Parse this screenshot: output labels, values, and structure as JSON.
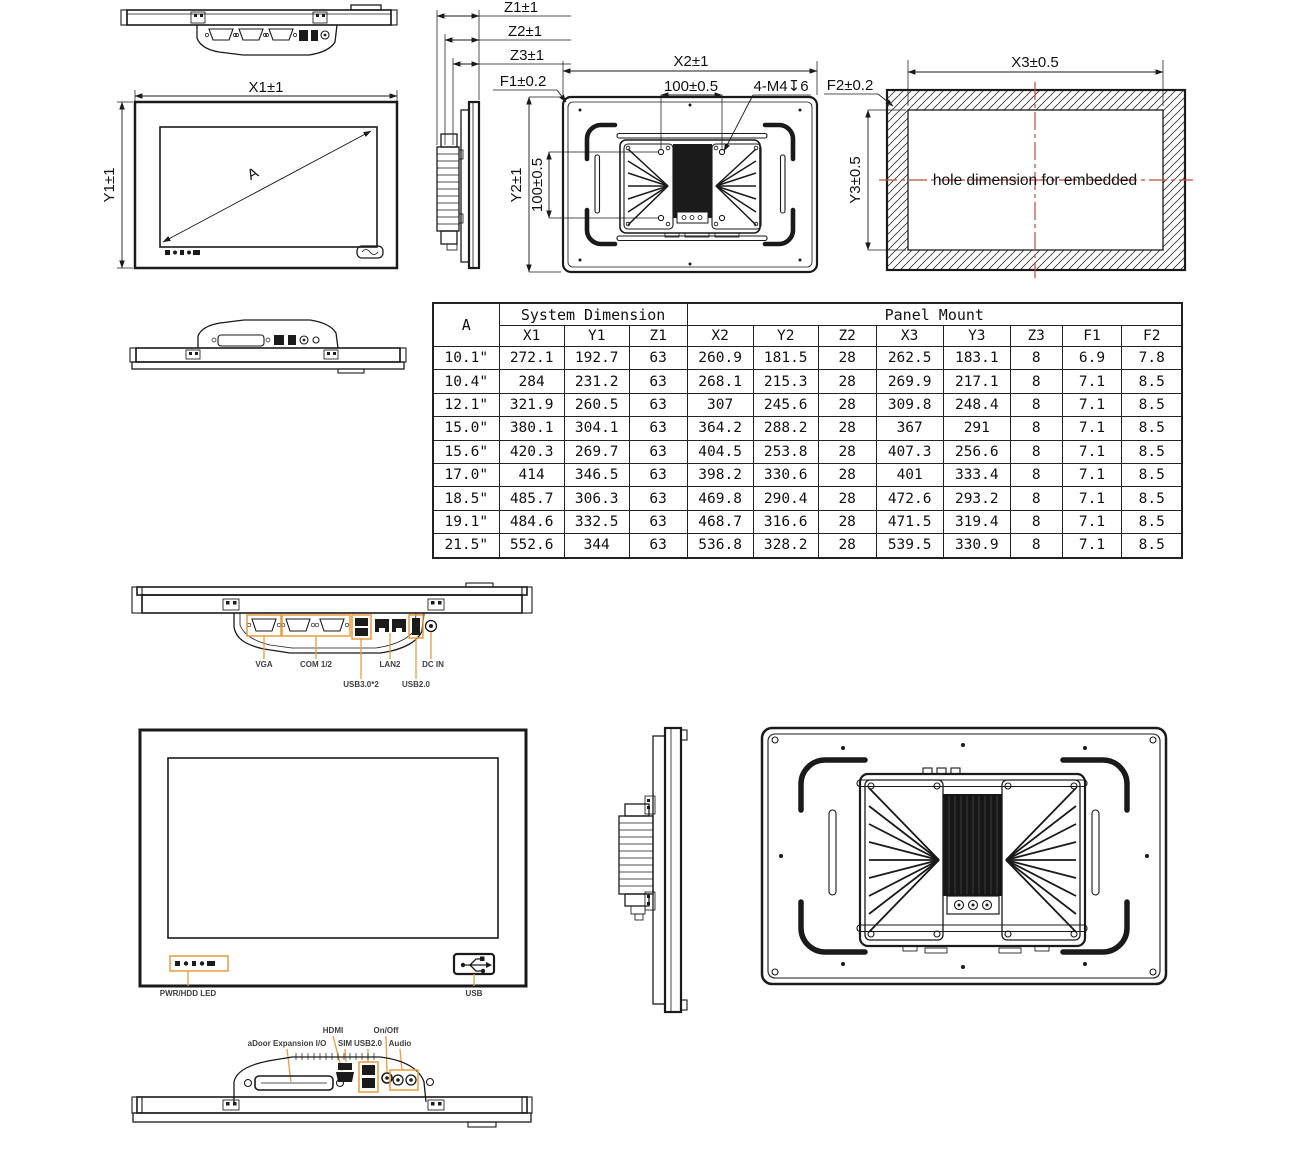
{
  "colors": {
    "line_black": "#1a1a1a",
    "highlight_orange": "#e89c3e",
    "centerline_red": "#bf4a3c"
  },
  "annotations": {
    "front": {
      "width": "X1±1",
      "height": "Y1±1",
      "diagonal_label": "A"
    },
    "side": {
      "z1": "Z1±1",
      "z2": "Z2±1",
      "z3": "Z3±1",
      "f1": "F1±0.2"
    },
    "rear": {
      "width": "X2±1",
      "vesa_h": "100±0.5",
      "thread": "4-M4↧6",
      "height": "Y2±1",
      "vesa_v": "100±0.5"
    },
    "cutout": {
      "width": "X3±0.5",
      "height": "Y3±0.5",
      "f2": "F2±0.2",
      "note": "hole dimension for embedded"
    }
  },
  "io_bottom": {
    "labels": [
      "VGA",
      "COM 1/2",
      "USB3.0*2",
      "LAN2",
      "USB2.0",
      "DC IN"
    ]
  },
  "front_panel": {
    "led": "PWR/HDD LED",
    "usb": "USB"
  },
  "io_top": {
    "labels": [
      "aDoor Expansion I/O",
      "HDMI",
      "SIM",
      "USB2.0",
      "On/Off",
      "Audio"
    ]
  },
  "dimension_table": {
    "corner_header": "A",
    "group_headers": [
      "System Dimension",
      "Panel Mount"
    ],
    "columns": [
      "X1",
      "Y1",
      "Z1",
      "X2",
      "Y2",
      "Z2",
      "X3",
      "Y3",
      "Z3",
      "F1",
      "F2"
    ],
    "rows": [
      {
        "size": "10.1\"",
        "values": [
          "272.1",
          "192.7",
          "63",
          "260.9",
          "181.5",
          "28",
          "262.5",
          "183.1",
          "8",
          "6.9",
          "7.8"
        ]
      },
      {
        "size": "10.4\"",
        "values": [
          "284",
          "231.2",
          "63",
          "268.1",
          "215.3",
          "28",
          "269.9",
          "217.1",
          "8",
          "7.1",
          "8.5"
        ]
      },
      {
        "size": "12.1\"",
        "values": [
          "321.9",
          "260.5",
          "63",
          "307",
          "245.6",
          "28",
          "309.8",
          "248.4",
          "8",
          "7.1",
          "8.5"
        ]
      },
      {
        "size": "15.0\"",
        "values": [
          "380.1",
          "304.1",
          "63",
          "364.2",
          "288.2",
          "28",
          "367",
          "291",
          "8",
          "7.1",
          "8.5"
        ]
      },
      {
        "size": "15.6\"",
        "values": [
          "420.3",
          "269.7",
          "63",
          "404.5",
          "253.8",
          "28",
          "407.3",
          "256.6",
          "8",
          "7.1",
          "8.5"
        ]
      },
      {
        "size": "17.0\"",
        "values": [
          "414",
          "346.5",
          "63",
          "398.2",
          "330.6",
          "28",
          "401",
          "333.4",
          "8",
          "7.1",
          "8.5"
        ]
      },
      {
        "size": "18.5\"",
        "values": [
          "485.7",
          "306.3",
          "63",
          "469.8",
          "290.4",
          "28",
          "472.6",
          "293.2",
          "8",
          "7.1",
          "8.5"
        ]
      },
      {
        "size": "19.1\"",
        "values": [
          "484.6",
          "332.5",
          "63",
          "468.7",
          "316.6",
          "28",
          "471.5",
          "319.4",
          "8",
          "7.1",
          "8.5"
        ]
      },
      {
        "size": "21.5\"",
        "values": [
          "552.6",
          "344",
          "63",
          "536.8",
          "328.2",
          "28",
          "539.5",
          "330.9",
          "8",
          "7.1",
          "8.5"
        ]
      }
    ]
  }
}
